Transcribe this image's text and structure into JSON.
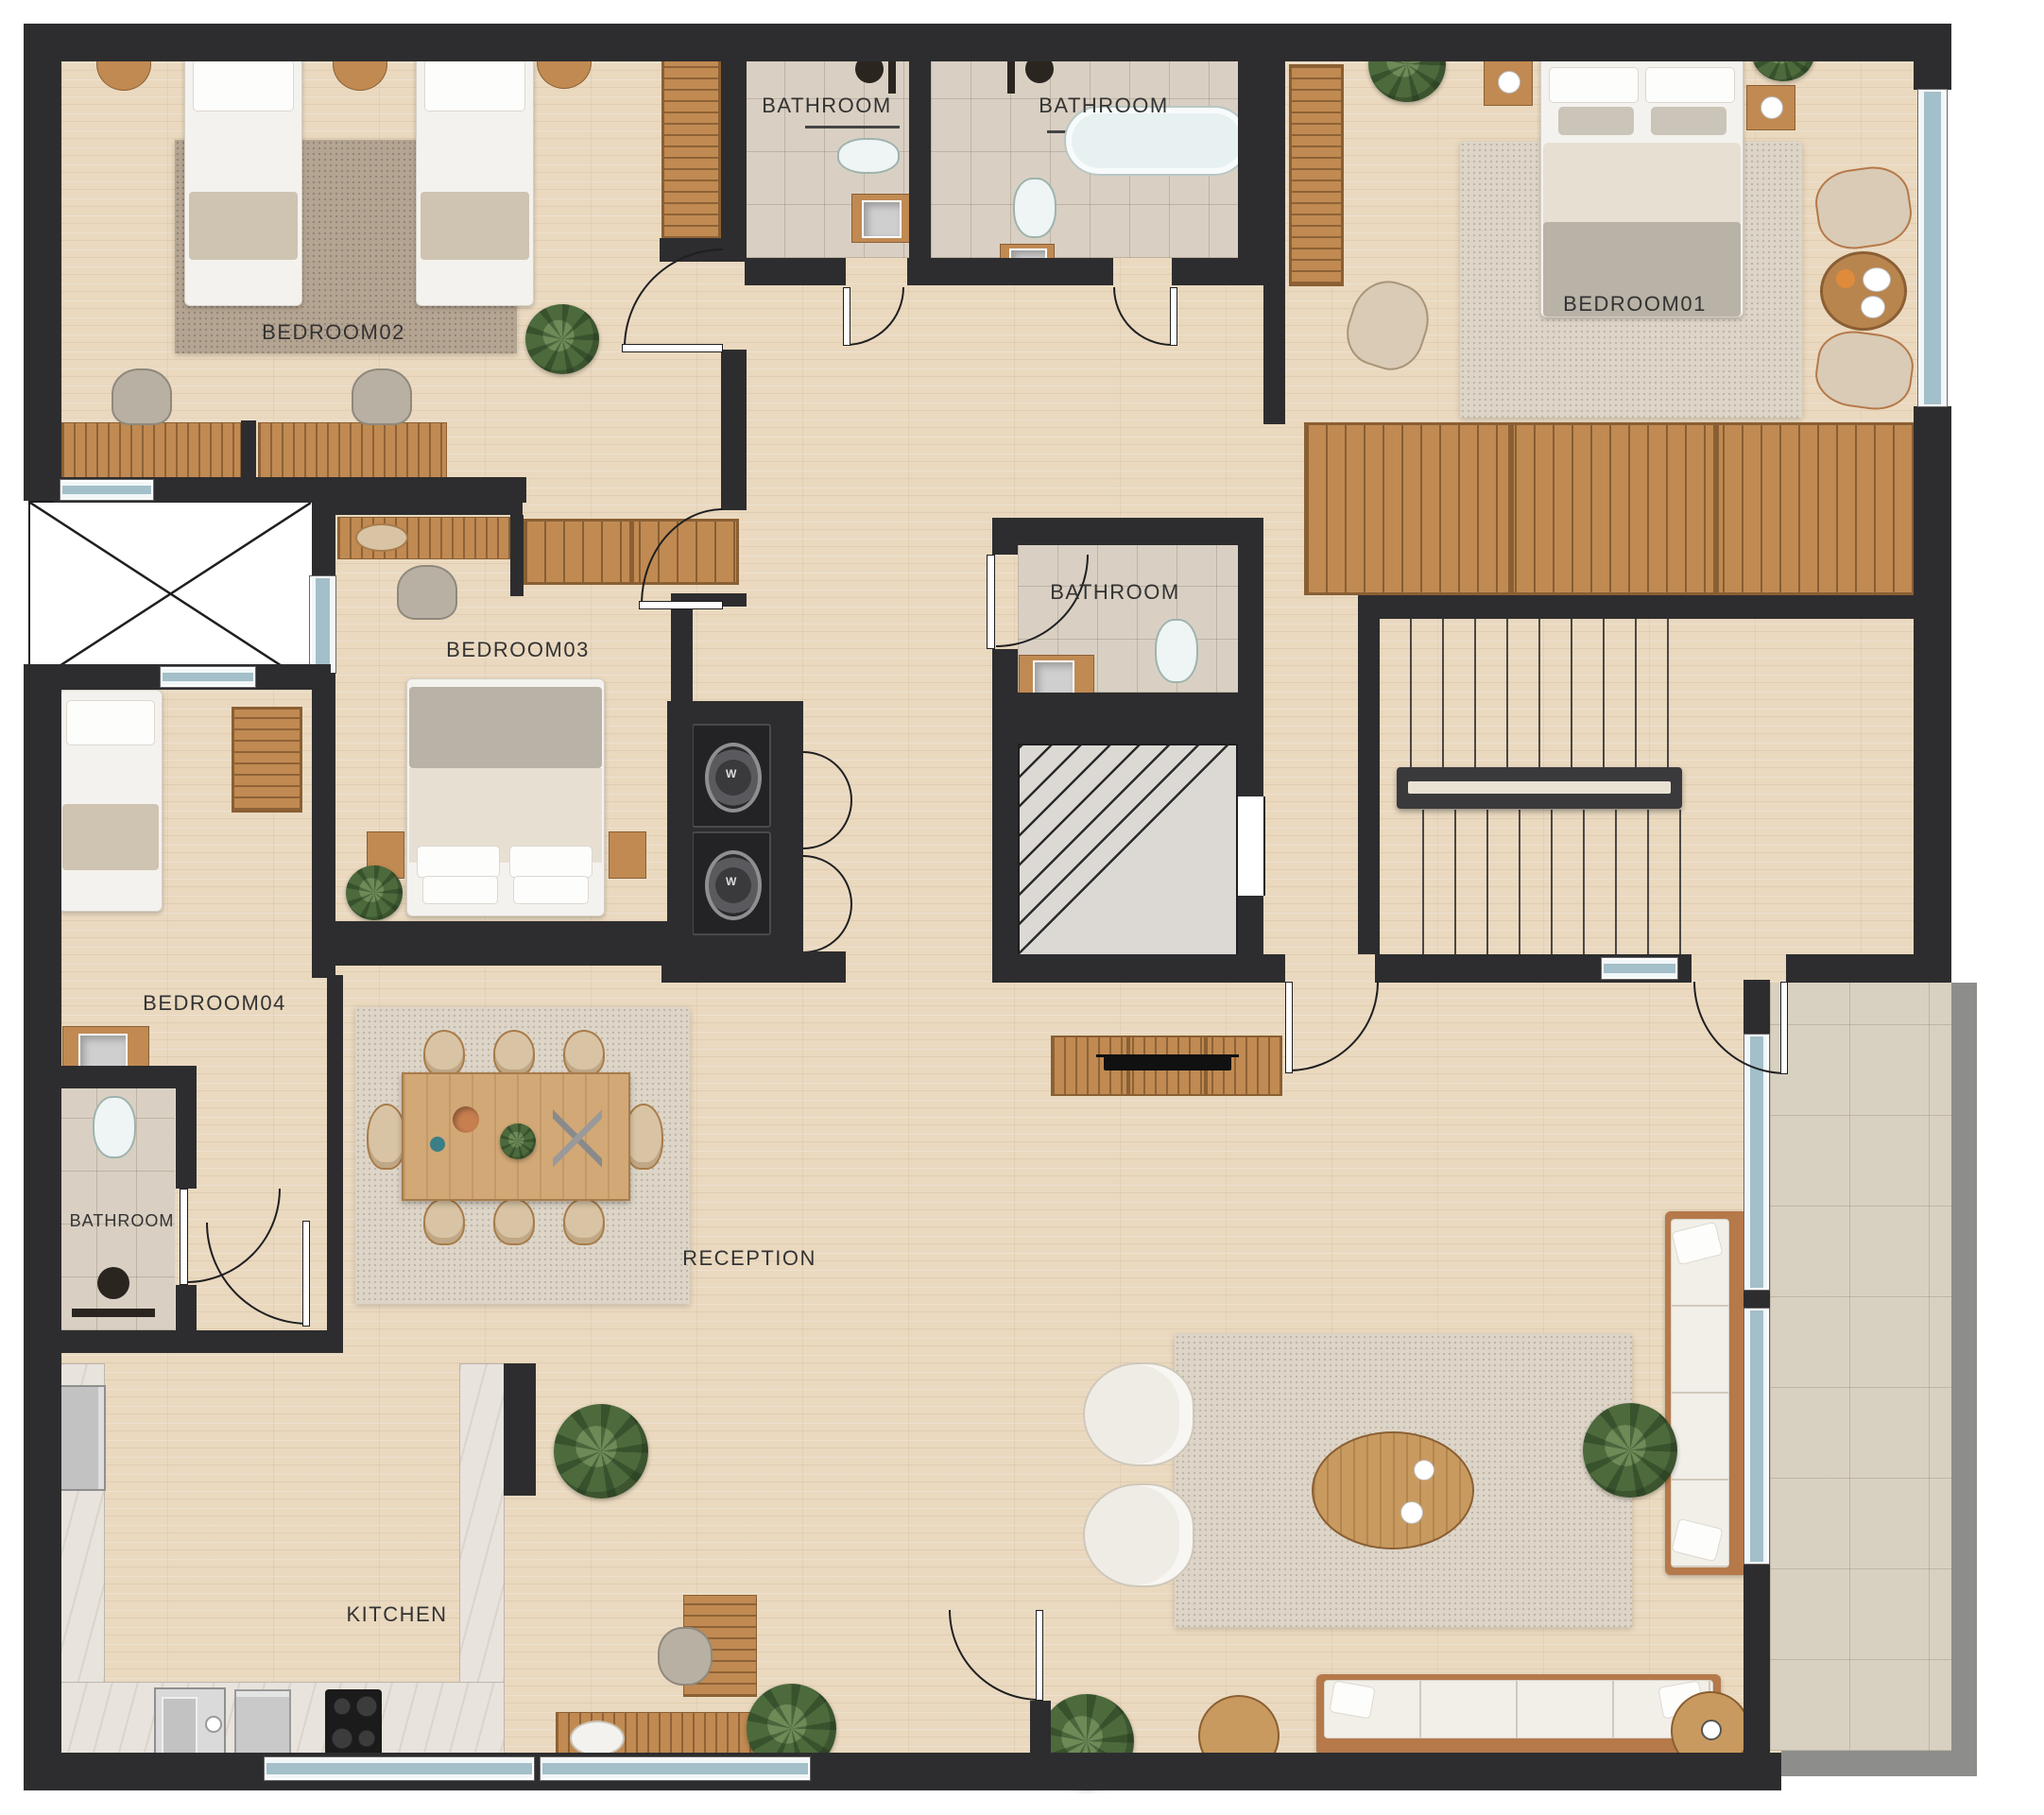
{
  "plan": {
    "type": "apartment-floor-plan"
  },
  "rooms": [
    {
      "id": "bedroom-02",
      "label": "BEDROOM02"
    },
    {
      "id": "bathroom-top-left",
      "label": "BATHROOM"
    },
    {
      "id": "bathroom-top-right",
      "label": "BATHROOM"
    },
    {
      "id": "bedroom-01",
      "label": "BEDROOM01"
    },
    {
      "id": "bathroom-middle",
      "label": "BATHROOM"
    },
    {
      "id": "bedroom-03",
      "label": "BEDROOM03"
    },
    {
      "id": "bedroom-04",
      "label": "BEDROOM04"
    },
    {
      "id": "bathroom-bottom-left",
      "label": "BATHROOM"
    },
    {
      "id": "reception",
      "label": "RECEPTION"
    },
    {
      "id": "kitchen",
      "label": "KITCHEN"
    }
  ],
  "appliances": {
    "washer_label": "W"
  },
  "colors": {
    "wall": "#2d2d2f",
    "wood_floor": "#ead9bf",
    "bath_tile": "#d9d0c3",
    "window_glass": "#a3bfc9",
    "wood_furniture": "#c08a52",
    "rug_dark": "#b4a492",
    "rug_light": "#ddd5c8",
    "balcony_tile": "#d8d1c2"
  }
}
